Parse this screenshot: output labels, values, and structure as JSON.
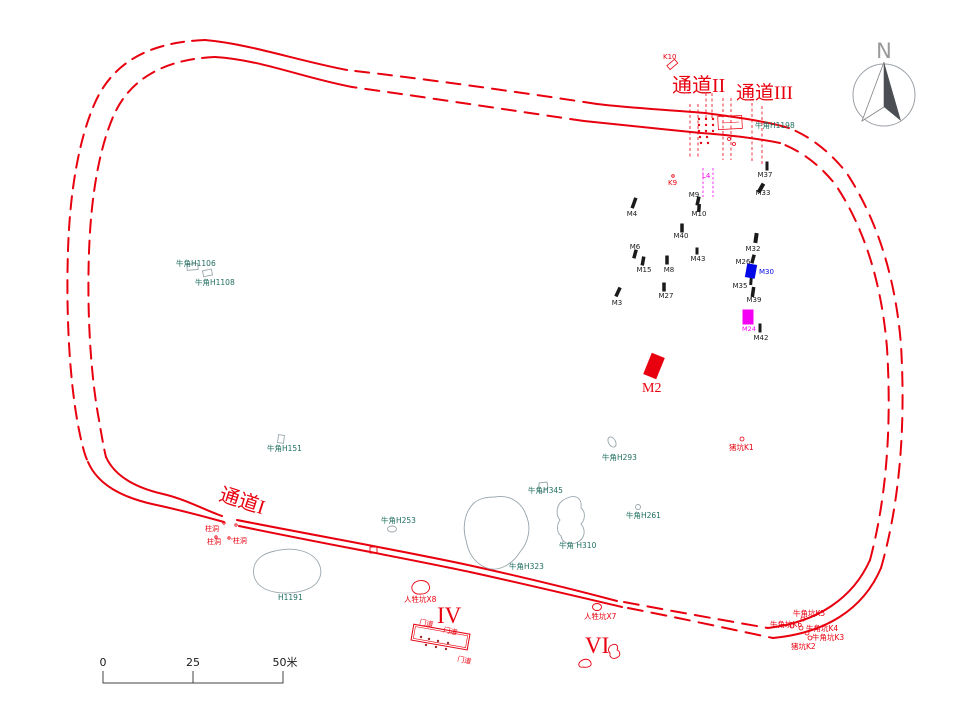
{
  "colors": {
    "red": "#e8000f",
    "teal": "#1f6f60",
    "blue": "#0008e8",
    "magenta": "#f400f4",
    "black": "#1a1a1a",
    "gray": "#9aa6ad",
    "north": "#9a9a9a",
    "dot_dark": "#9b2b2b"
  },
  "north_label": "N",
  "scale_bar": {
    "ticks": [
      "0",
      "25",
      "50米"
    ]
  },
  "passages": [
    "通道I",
    "通道II",
    "通道III"
  ],
  "labels": [
    {
      "t": "K10",
      "x": 663,
      "y": 59,
      "fs": 7,
      "c": "red"
    },
    {
      "t": "通道II",
      "x": 672,
      "y": 92,
      "fs": 20,
      "c": "red",
      "sf": 1
    },
    {
      "t": "通道III",
      "x": 736,
      "y": 99,
      "fs": 19,
      "c": "red",
      "sf": 1
    },
    {
      "t": "牛角H1198",
      "x": 755,
      "y": 128,
      "fs": 7.5,
      "c": "teal"
    },
    {
      "t": "K9",
      "x": 668,
      "y": 185,
      "fs": 7,
      "c": "red"
    },
    {
      "t": "L4",
      "x": 702,
      "y": 178,
      "fs": 7,
      "c": "magenta"
    },
    {
      "t": "M37",
      "x": 765,
      "y": 177,
      "fs": 7,
      "c": "black",
      "a": "m"
    },
    {
      "t": "M33",
      "x": 763,
      "y": 195,
      "fs": 7,
      "c": "black",
      "a": "m"
    },
    {
      "t": "M4",
      "x": 632,
      "y": 216,
      "fs": 7,
      "c": "black",
      "a": "m"
    },
    {
      "t": "M9",
      "x": 694,
      "y": 197,
      "fs": 7,
      "c": "black",
      "a": "m"
    },
    {
      "t": "M10",
      "x": 699,
      "y": 216,
      "fs": 7,
      "c": "black",
      "a": "m"
    },
    {
      "t": "M40",
      "x": 681,
      "y": 238,
      "fs": 7,
      "c": "black",
      "a": "m"
    },
    {
      "t": "M6",
      "x": 635,
      "y": 249,
      "fs": 7,
      "c": "black",
      "a": "m"
    },
    {
      "t": "M43",
      "x": 698,
      "y": 261,
      "fs": 7,
      "c": "black",
      "a": "m"
    },
    {
      "t": "M32",
      "x": 753,
      "y": 251,
      "fs": 7,
      "c": "black",
      "a": "m"
    },
    {
      "t": "M26",
      "x": 743,
      "y": 264,
      "fs": 7,
      "c": "black",
      "a": "m"
    },
    {
      "t": "M30",
      "x": 759,
      "y": 274,
      "fs": 7,
      "c": "blue"
    },
    {
      "t": "M15",
      "x": 644,
      "y": 272,
      "fs": 7,
      "c": "black",
      "a": "m"
    },
    {
      "t": "M8",
      "x": 669,
      "y": 272,
      "fs": 7,
      "c": "black",
      "a": "m"
    },
    {
      "t": "M35",
      "x": 740,
      "y": 288,
      "fs": 7,
      "c": "black",
      "a": "m"
    },
    {
      "t": "M39",
      "x": 754,
      "y": 302,
      "fs": 7,
      "c": "black",
      "a": "m"
    },
    {
      "t": "M27",
      "x": 666,
      "y": 298,
      "fs": 7,
      "c": "black",
      "a": "m"
    },
    {
      "t": "M3",
      "x": 617,
      "y": 305,
      "fs": 7,
      "c": "black",
      "a": "m"
    },
    {
      "t": "M24",
      "x": 749,
      "y": 331,
      "fs": 6.5,
      "c": "magenta",
      "a": "m"
    },
    {
      "t": "M42",
      "x": 761,
      "y": 340,
      "fs": 7,
      "c": "black",
      "a": "m"
    },
    {
      "t": "M2",
      "x": 642,
      "y": 392,
      "fs": 14,
      "c": "red",
      "sf": 1
    },
    {
      "t": "牛角H1106",
      "x": 176,
      "y": 266,
      "fs": 7.5,
      "c": "teal"
    },
    {
      "t": "牛角H1108",
      "x": 195,
      "y": 285,
      "fs": 7.5,
      "c": "teal"
    },
    {
      "t": "牛角H151",
      "x": 267,
      "y": 451,
      "fs": 7.5,
      "c": "teal"
    },
    {
      "t": "牛角H293",
      "x": 602,
      "y": 460,
      "fs": 7.5,
      "c": "teal"
    },
    {
      "t": "猪坑K1",
      "x": 729,
      "y": 450,
      "fs": 7.5,
      "c": "red"
    },
    {
      "t": "牛角H345",
      "x": 528,
      "y": 493,
      "fs": 7.5,
      "c": "teal"
    },
    {
      "t": "牛角H261",
      "x": 626,
      "y": 518,
      "fs": 7.5,
      "c": "teal"
    },
    {
      "t": "牛角 H310",
      "x": 559,
      "y": 548,
      "fs": 7.5,
      "c": "teal"
    },
    {
      "t": "牛角H323",
      "x": 509,
      "y": 569,
      "fs": 7.5,
      "c": "teal"
    },
    {
      "t": "牛角H253",
      "x": 381,
      "y": 523,
      "fs": 7.5,
      "c": "teal"
    },
    {
      "t": "H1191",
      "x": 278,
      "y": 600,
      "fs": 7.5,
      "c": "teal"
    },
    {
      "t": "通道I",
      "x": 218,
      "y": 500,
      "fs": 20,
      "c": "red",
      "sf": 1,
      "rot": 18
    },
    {
      "t": "柱洞",
      "x": 205,
      "y": 531,
      "fs": 7,
      "c": "red"
    },
    {
      "t": "柱洞",
      "x": 207,
      "y": 544,
      "fs": 7,
      "c": "red"
    },
    {
      "t": "'柱洞",
      "x": 231,
      "y": 543,
      "fs": 7,
      "c": "red"
    },
    {
      "t": "人牲坑X8",
      "x": 404,
      "y": 602,
      "fs": 7.5,
      "c": "red"
    },
    {
      "t": "IV",
      "x": 437,
      "y": 623,
      "fs": 23,
      "c": "red",
      "sf": 1
    },
    {
      "t": "门道",
      "x": 419,
      "y": 624,
      "fs": 7,
      "c": "red",
      "rot": 12
    },
    {
      "t": "门道",
      "x": 443,
      "y": 632,
      "fs": 7,
      "c": "red",
      "rot": 12
    },
    {
      "t": "门道",
      "x": 457,
      "y": 661,
      "fs": 7,
      "c": "red",
      "rot": 12
    },
    {
      "t": "人牲坑X7",
      "x": 584,
      "y": 619,
      "fs": 7.5,
      "c": "red"
    },
    {
      "t": "VI",
      "x": 585,
      "y": 653,
      "fs": 23,
      "c": "red",
      "sf": 1
    },
    {
      "t": "牛角坑K5",
      "x": 793,
      "y": 616,
      "fs": 7.5,
      "c": "red"
    },
    {
      "t": "牛角坑K6",
      "x": 770,
      "y": 627,
      "fs": 7.5,
      "c": "red"
    },
    {
      "t": "牛角坑K4",
      "x": 806,
      "y": 631,
      "fs": 7.5,
      "c": "red"
    },
    {
      "t": "牛角坑K3",
      "x": 812,
      "y": 640,
      "fs": 7.5,
      "c": "red"
    },
    {
      "t": "猪坑K2",
      "x": 791,
      "y": 649,
      "fs": 7.5,
      "c": "red"
    },
    {
      "t": "0",
      "x": 103,
      "y": 666,
      "fs": 11,
      "c": "black",
      "a": "m"
    },
    {
      "t": "25",
      "x": 193,
      "y": 666,
      "fs": 11,
      "c": "black",
      "a": "m"
    },
    {
      "t": "50米",
      "x": 285,
      "y": 666,
      "fs": 11,
      "c": "black",
      "a": "m"
    },
    {
      "t": "N",
      "x": 884,
      "y": 58,
      "fs": 21,
      "c": "north",
      "a": "m"
    }
  ],
  "tomb_bars": [
    [
      634,
      203,
      3.5,
      11,
      20
    ],
    [
      698,
      201,
      3.5,
      9,
      12
    ],
    [
      699,
      208,
      3.5,
      8,
      4
    ],
    [
      682,
      228,
      3.5,
      9,
      0
    ],
    [
      635,
      254,
      3.5,
      9,
      15
    ],
    [
      697,
      251,
      3,
      7,
      0
    ],
    [
      643,
      261,
      3.5,
      9,
      10
    ],
    [
      667,
      260,
      3.5,
      9,
      0
    ],
    [
      664,
      287,
      3.5,
      9,
      0
    ],
    [
      618,
      292,
      3.5,
      10,
      25
    ],
    [
      767,
      166,
      3,
      9,
      0
    ],
    [
      761,
      188,
      4,
      10,
      30
    ],
    [
      756,
      238,
      4,
      10,
      8
    ],
    [
      753,
      259,
      3.5,
      9,
      15
    ],
    [
      751,
      281,
      3,
      8,
      5
    ],
    [
      753,
      292,
      3.5,
      10,
      8
    ],
    [
      760,
      328,
      3,
      9,
      0
    ]
  ],
  "filled_tombs": [
    {
      "id": "M30",
      "cx": 751,
      "cy": 271,
      "w": 10,
      "h": 14,
      "rot": 10,
      "c": "blue"
    },
    {
      "id": "M24",
      "cx": 748,
      "cy": 317,
      "w": 11,
      "h": 15,
      "rot": 0,
      "c": "magenta"
    },
    {
      "id": "M2",
      "cx": 654,
      "cy": 366,
      "w": 14,
      "h": 23,
      "rot": 22,
      "c": "red"
    }
  ],
  "posthole_dots": [
    [
      699,
      119
    ],
    [
      706,
      119
    ],
    [
      713,
      119
    ],
    [
      699,
      125
    ],
    [
      706,
      125
    ],
    [
      713,
      125
    ],
    [
      699,
      131
    ],
    [
      706,
      131
    ],
    [
      713,
      131
    ],
    [
      700,
      137
    ],
    [
      707,
      137
    ],
    [
      701,
      143
    ],
    [
      708,
      143
    ]
  ],
  "small_red_circles": [
    [
      742,
      439,
      2
    ],
    [
      803,
      619,
      2
    ],
    [
      792,
      626,
      2
    ],
    [
      801,
      628,
      2
    ],
    [
      807,
      633,
      2
    ],
    [
      810,
      638,
      2
    ],
    [
      673,
      176,
      1.3
    ],
    [
      224,
      523,
      1.2
    ],
    [
      236,
      525,
      1.2
    ],
    [
      216,
      537,
      1.2
    ],
    [
      229,
      538,
      1.2
    ],
    [
      729,
      139,
      1.5
    ],
    [
      734,
      144,
      1.5
    ]
  ],
  "building_dots": [
    [
      421,
      637
    ],
    [
      429,
      639
    ],
    [
      438,
      641
    ],
    [
      448,
      643
    ],
    [
      426,
      645
    ],
    [
      436,
      647
    ],
    [
      446,
      649
    ]
  ]
}
